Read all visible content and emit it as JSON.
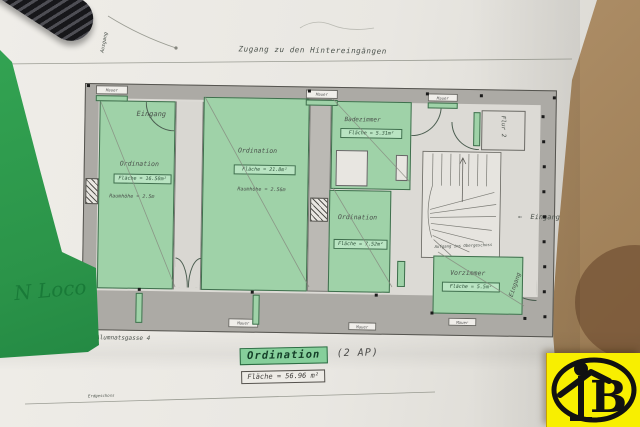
{
  "plan": {
    "top_note": "Zugang zu den Hintereingängen",
    "exit_label": "Ausgang",
    "wall_label": "Mauer",
    "rooms": [
      {
        "name": "Ordination",
        "area": "Fläche = 16.50m²",
        "height": "Raumhöhe = 2.5m",
        "door": "Eingang"
      },
      {
        "name": "Ordination",
        "area": "Fläche = 21.8m²",
        "height": "Raumhöhe = 2.56m"
      },
      {
        "name": "Badezimmer",
        "area": "Fläche = 5.31m²"
      },
      {
        "name": "Ordination",
        "area": "Fläche = 7.52m²"
      },
      {
        "name": "Flur 2"
      },
      {
        "name": "Vorzimmer",
        "area": "Fläche = 5.5m²",
        "door": "Eingang"
      }
    ],
    "stair_note": "Aufgang ins Obergeschoss",
    "entrance_arrow": "←",
    "entrance_label": "Eingang",
    "street_label": "Alumnatsgasse 4",
    "gas_label": "Gas",
    "floor_note": "Erdgeschoss"
  },
  "summary": {
    "room": "Ordination",
    "suffix": "(2 AP)",
    "area": "Fläche = 56.96 m²"
  },
  "handwriting": "N Loco",
  "logo": {
    "letter": "B"
  },
  "colors": {
    "room_green": "#9fd2a8",
    "wall_gray": "#acaaa5",
    "logo_yellow": "#f8ef00",
    "green_paper": "#2b9449"
  }
}
